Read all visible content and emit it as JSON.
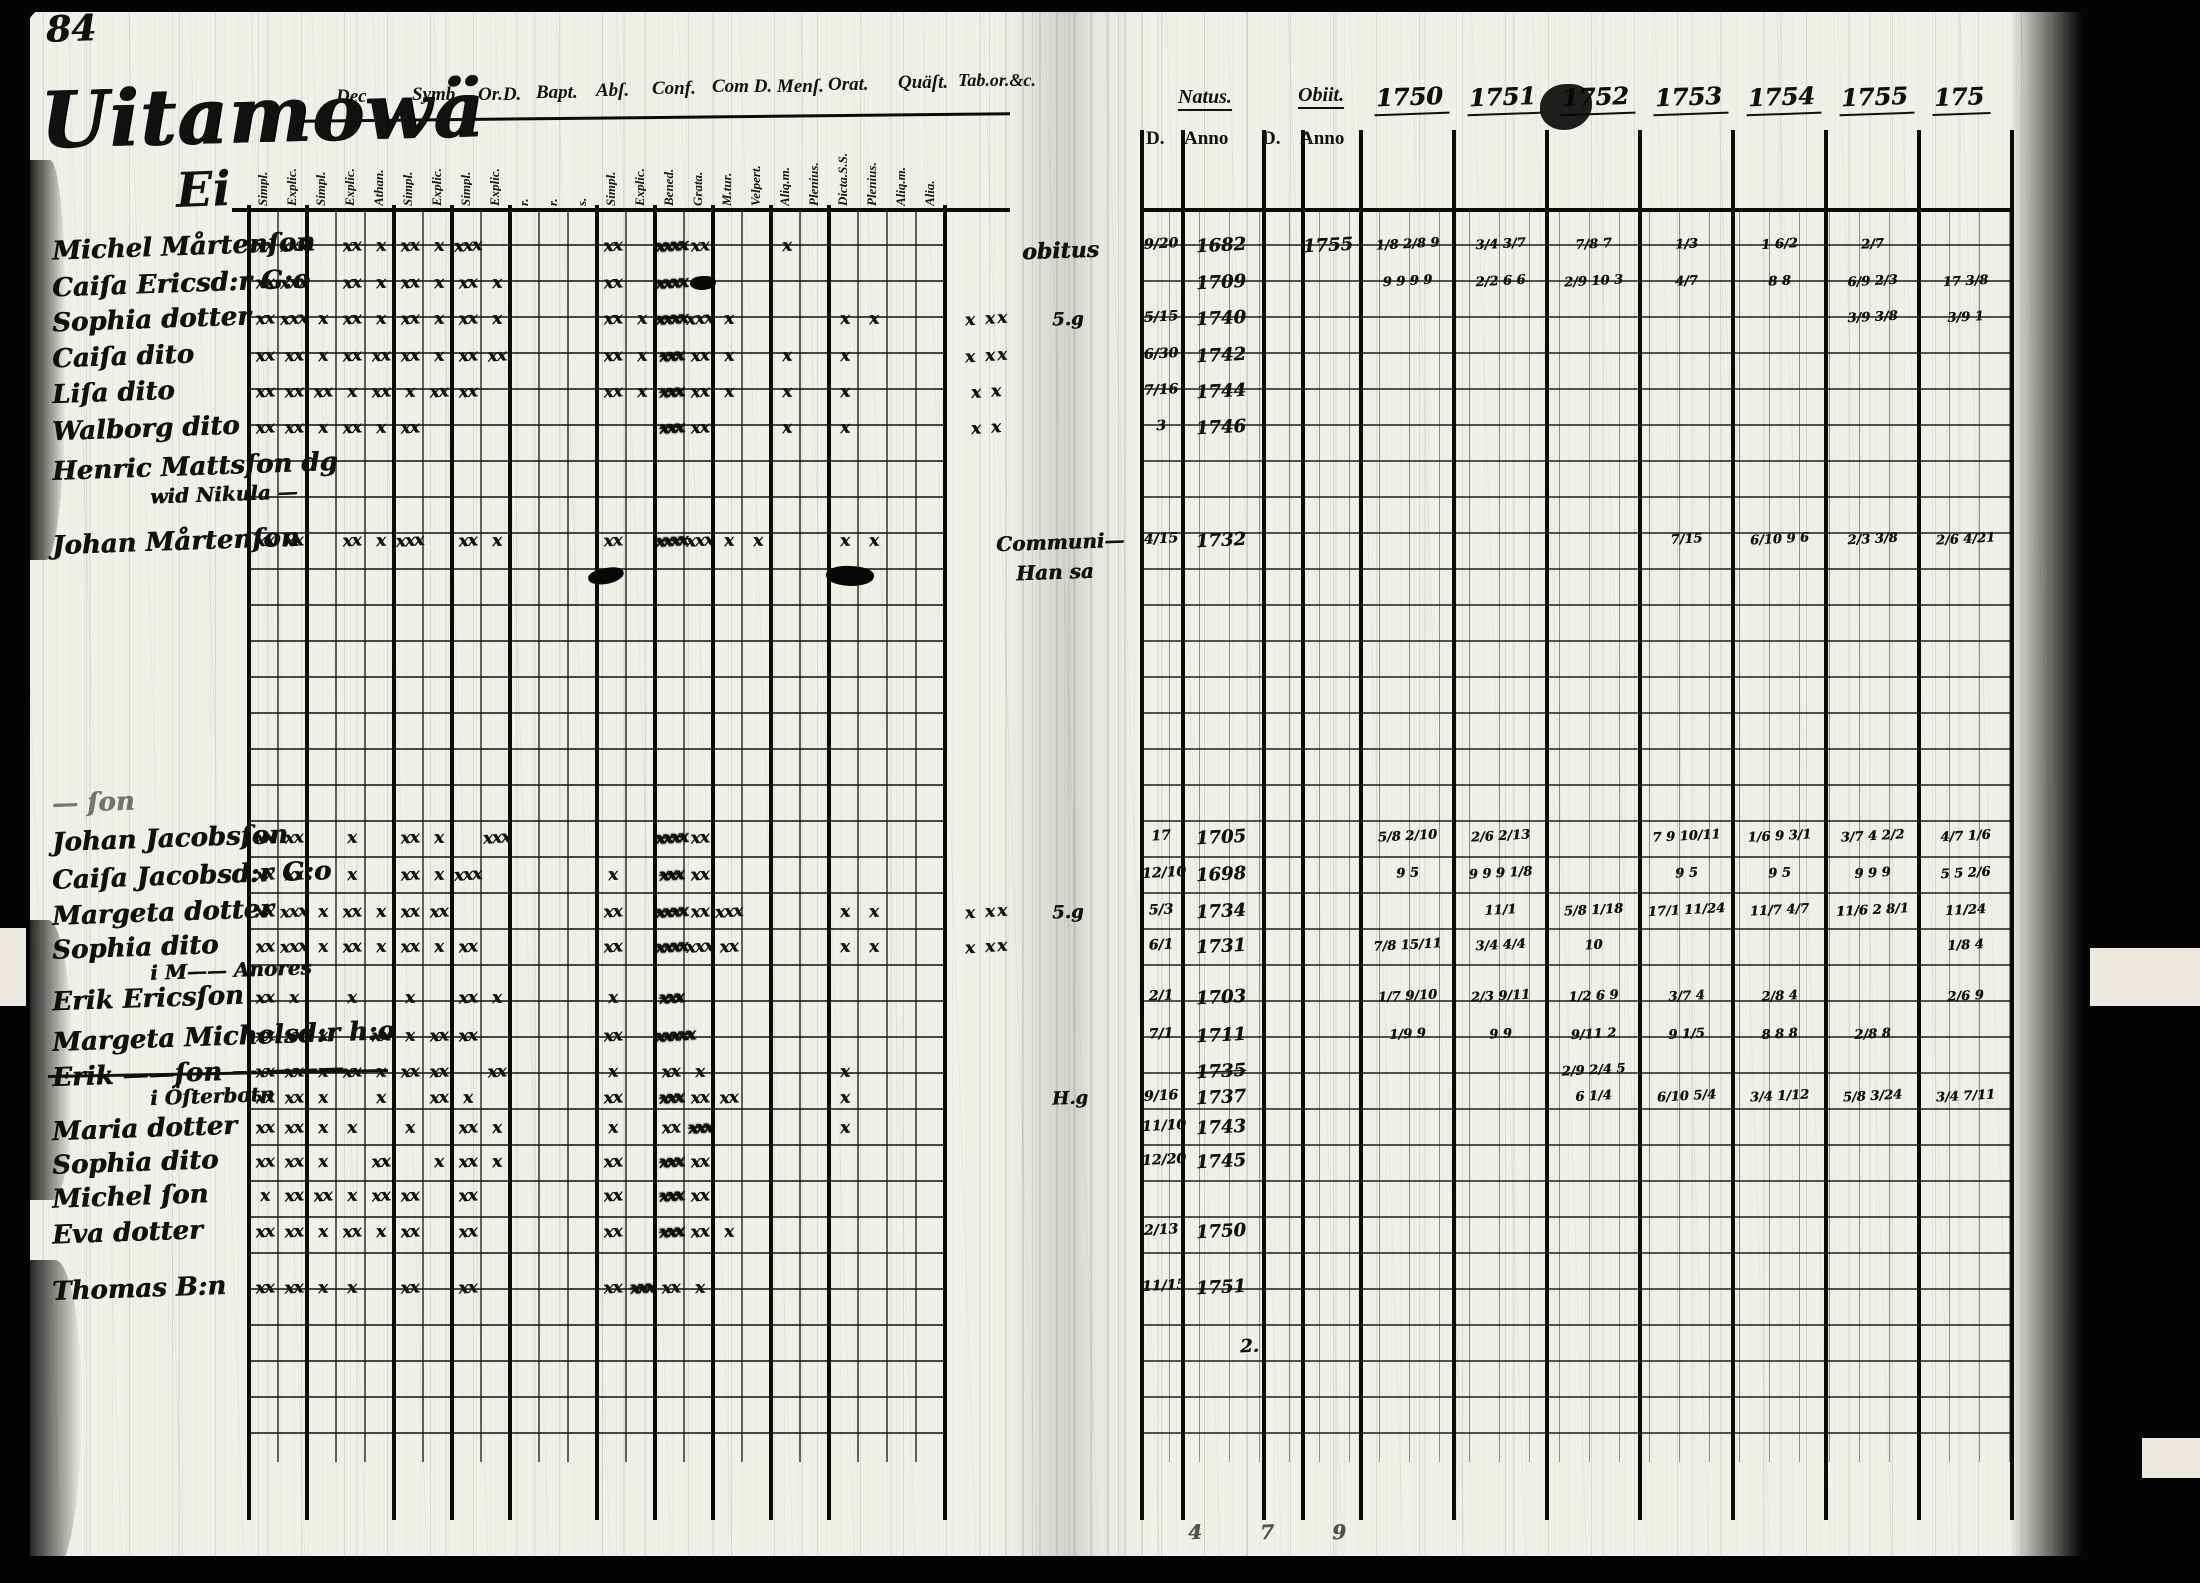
{
  "page": {
    "number": "84",
    "title_line1": "Uitamowä",
    "title_line2": "Ei"
  },
  "left_table": {
    "top_headers": [
      "Dec.",
      "Symb.",
      "Or.D.",
      "Bapt.",
      "Abſ.",
      "Conf.",
      "Com D. Menſ.",
      "Orat.",
      "Quäſt.",
      "Tab.or.&c."
    ],
    "sub_headers": [
      "Simpl.",
      "Explic.",
      "Simpl.",
      "Explic.",
      "Athan.",
      "Simpl.",
      "Explic.",
      "Simpl.",
      "Explic.",
      "r.",
      "r.",
      "s.",
      "Simpl.",
      "Explic.",
      "Bened.",
      "Grata.",
      "M.tur.",
      "Velpert.",
      "Aliq.m.",
      "Plenius.",
      "Dicta.S.S.",
      "Plenius.",
      "Aliq.m.",
      "Alia."
    ]
  },
  "right_table": {
    "natus_label": "Natus.",
    "obiit_label": "Obiit.",
    "day_anno_headers": [
      "D.",
      "Anno",
      "D.",
      "Anno"
    ],
    "year_headers": [
      "1750",
      "1751",
      "1752",
      "1753",
      "1754",
      "1755",
      "175"
    ]
  },
  "records": [
    {
      "name": "Michel Mårtenſon",
      "marks": [
        "xx",
        "xxx",
        "",
        "xx",
        "x",
        "xx",
        "x",
        "xxx",
        "",
        "",
        "",
        "",
        "xx",
        "",
        "~xxxx",
        "xx",
        "",
        "",
        "x"
      ],
      "nd": "9/20",
      "na": "1682",
      "on": "obitus",
      "oa": "1755",
      "years": [
        "1/8 2/8 9",
        "3/4 3/7",
        "7/8 7",
        "1/3",
        "1 6/2",
        "2/7",
        ""
      ]
    },
    {
      "name": "Caiſa Ericsd:r G:o",
      "marks": [
        "xx",
        "xxx",
        "",
        "xx",
        "x",
        "xx",
        "x",
        "xx",
        "x",
        "",
        "",
        "",
        "xx",
        "",
        "~xxxx",
        "x"
      ],
      "na": "1709",
      "years": [
        "9 9 9 9",
        "2/2 6 6",
        "2/9 10 3",
        "4/7",
        "8 8",
        "6/9 2/3",
        "17 3/8"
      ]
    },
    {
      "name": "Sophia dotter",
      "marks": [
        "xx",
        "xxx",
        "x",
        "xx",
        "x",
        "xx",
        "x",
        "xx",
        "x",
        "",
        "",
        "",
        "xx",
        "x",
        "~xxxx",
        "xxx",
        "x",
        "",
        "",
        "",
        "x",
        "x"
      ],
      "extra": "x xx",
      "note": "5.g",
      "nd": "5/15",
      "na": "1740",
      "years": [
        "",
        "",
        "",
        "",
        "",
        "3/9 3/8",
        "3/9 1"
      ]
    },
    {
      "name": "Caiſa dito",
      "marks": [
        "xx",
        "xx",
        "x",
        "xx",
        "xx",
        "xx",
        "x",
        "xx",
        "xx",
        "",
        "",
        "",
        "xx",
        "x",
        "~xxx",
        "xx",
        "x",
        "",
        "x",
        "",
        "x"
      ],
      "extra": "x xx",
      "nd": "6/30",
      "na": "1742"
    },
    {
      "name": "Liſa dito",
      "marks": [
        "xx",
        "xx",
        "xx",
        "x",
        "xx",
        "x",
        "xx",
        "xx",
        "",
        "",
        "",
        "",
        "xx",
        "x",
        "~xxx",
        "xx",
        "x",
        "",
        "x",
        "",
        "x"
      ],
      "extra": "x x",
      "nd": "7/16",
      "na": "1744"
    },
    {
      "name": "Walborg dito",
      "marks": [
        "xx",
        "xx",
        "x",
        "xx",
        "x",
        "xx",
        "",
        "",
        "",
        "",
        "",
        "",
        "",
        "",
        "~xxx",
        "xx",
        "",
        "",
        "x",
        "",
        "x"
      ],
      "extra": "x x",
      "nd": "3",
      "na": "1746"
    },
    {
      "name": "Henric Mattsſon dg"
    },
    {
      "name": "wid Nikula —",
      "indent": true
    },
    {
      "name": "Johan Mårtenſon",
      "marks": [
        "xx",
        "xx",
        "",
        "xx",
        "x",
        "xxx",
        "",
        "xx",
        "x",
        "",
        "",
        "",
        "xx",
        "",
        "~xxxx",
        "xxx",
        "x",
        "x",
        "",
        "",
        "x",
        "x"
      ],
      "nd": "4/15",
      "na": "1732",
      "years": [
        "",
        "",
        "",
        "7/15",
        "6/10 9 6",
        "2/3 3/8",
        "2/6 4/21"
      ]
    },
    {
      "name": "— ſon",
      "faint": true
    },
    {
      "name": "Johan Jacobsſon",
      "marks": [
        "xx",
        "xx",
        "",
        "x",
        "",
        "xx",
        "x",
        "",
        "xxx",
        "",
        "",
        "",
        "",
        "",
        "~xxxx",
        "xx"
      ],
      "nd": "17",
      "na": "1705",
      "years": [
        "5/8 2/10",
        "2/6 2/13",
        "",
        "7 9 10/11",
        "1/6 9 3/1",
        "3/7 4 2/2",
        "4/7 1/6"
      ]
    },
    {
      "name": "Caiſa Jacobsd:r G:o",
      "marks": [
        "xx",
        "xx",
        "",
        "x",
        "",
        "xx",
        "x",
        "xxx",
        "",
        "",
        "",
        "",
        "x",
        "",
        "~xxx",
        "xx"
      ],
      "nd": "12/10",
      "na": "1698",
      "years": [
        "9 5",
        "9 9 9 1/8",
        "",
        "9 5",
        "9 5",
        "9 9 9",
        "5 5 2/6"
      ]
    },
    {
      "name": "Margeta dotter",
      "marks": [
        "xx",
        "xxx",
        "x",
        "xx",
        "x",
        "xx",
        "xx",
        "",
        "",
        "",
        "",
        "",
        "xx",
        "",
        "~xxxx",
        "xx",
        "xxx",
        "",
        "",
        "",
        "x",
        "x"
      ],
      "extra": "x xx",
      "note": "5.g",
      "nd": "5/3",
      "na": "1734",
      "years": [
        "",
        "11/1",
        "5/8 1/18",
        "17/1 11/24",
        "11/7 4/7",
        "11/6 2 8/1",
        "11/24"
      ]
    },
    {
      "name": "Sophia dito",
      "marks": [
        "xx",
        "xxx",
        "x",
        "xx",
        "x",
        "xx",
        "x",
        "xx",
        "",
        "",
        "",
        "",
        "xx",
        "",
        "~xxxx",
        "xxx",
        "xx",
        "",
        "",
        "",
        "x",
        "x"
      ],
      "extra": "x xx",
      "nd": "6/1",
      "na": "1731",
      "years": [
        "7/8 15/11",
        "3/4 4/4",
        "10",
        "",
        "",
        "",
        "1/8 4"
      ]
    },
    {
      "name": "i M—— Anores",
      "indent": true
    },
    {
      "name": "Erik Ericsſon",
      "marks": [
        "xx",
        "x",
        "",
        "x",
        "",
        "x",
        "",
        "xx",
        "x",
        "",
        "",
        "",
        "x",
        "",
        "~xxx"
      ],
      "nd": "2/1",
      "na": "1703",
      "years": [
        "1/7 9/10",
        "2/3 9/11",
        "1/2 6 9",
        "3/7 4",
        "2/8 4",
        "",
        "2/6 9"
      ]
    },
    {
      "name": "Margeta Michelsd:r h:o",
      "marks": [
        "xx",
        "xx",
        "x",
        "",
        "xx",
        "x",
        "xx",
        "xx",
        "",
        "",
        "",
        "",
        "xx",
        "",
        "~xxxxx"
      ],
      "nd": "7/1",
      "na": "1711",
      "years": [
        "1/9 9",
        "9 9",
        "9/11 2",
        "9 1/5",
        "8 8 8",
        "2/8 8",
        ""
      ]
    },
    {
      "name": "Erik ——ſon — ———",
      "struck": true,
      "marks": [
        "xx",
        "xx",
        "x",
        "xx",
        "x",
        "xx",
        "xx",
        "",
        "xx",
        "",
        "",
        "",
        "x",
        "",
        "xx",
        "x",
        "",
        "",
        "",
        "",
        "x"
      ],
      "na": "1735",
      "years": [
        "",
        "",
        "2/9 2/4 5",
        "",
        "",
        "",
        ""
      ]
    },
    {
      "name": "i Öſterbotn",
      "indent": true,
      "marks": [
        "xx",
        "xx",
        "x",
        "",
        "x",
        "",
        "xx",
        "x",
        "",
        "",
        "",
        "",
        "xx",
        "",
        "~xxx",
        "xx",
        "xx",
        "",
        "",
        "",
        "x"
      ],
      "note": "H.g",
      "nd": "9/16",
      "na": "1737",
      "years": [
        "",
        "",
        "6 1/4",
        "6/10 5/4",
        "3/4 1/12",
        "5/8 3/24",
        "3/4 7/11"
      ]
    },
    {
      "name": "Maria dotter",
      "marks": [
        "xx",
        "xx",
        "x",
        "x",
        "",
        "x",
        "",
        "xx",
        "x",
        "",
        "",
        "",
        "x",
        "",
        "xx",
        "~xxx",
        "",
        "",
        "",
        "",
        "x"
      ],
      "nd": "11/10",
      "na": "1743"
    },
    {
      "name": "Sophia dito",
      "marks": [
        "xx",
        "xx",
        "x",
        "",
        "xx",
        "",
        "x",
        "xx",
        "x",
        "",
        "",
        "",
        "xx",
        "",
        "~xxx",
        "xx"
      ],
      "nd": "12/20",
      "na": "1745"
    },
    {
      "name": "Michel ſon",
      "marks": [
        "x",
        "xx",
        "xx",
        "x",
        "xx",
        "xx",
        "",
        "xx",
        "",
        "",
        "",
        "",
        "xx",
        "",
        "~xxx",
        "xx"
      ]
    },
    {
      "name": "Eva dotter",
      "marks": [
        "xx",
        "xx",
        "x",
        "xx",
        "x",
        "xx",
        "",
        "xx",
        "",
        "",
        "",
        "",
        "xx",
        "",
        "~xxx",
        "xx",
        "x"
      ],
      "nd": "2/13",
      "na": "1750"
    },
    {
      "name": "Thomas B:n",
      "marks": [
        "xx",
        "xx",
        "x",
        "x",
        "",
        "xx",
        "",
        "xx",
        "",
        "",
        "",
        "",
        "xx",
        "~xxx",
        "xx",
        "x"
      ],
      "nd": "11/15",
      "na": "1751"
    }
  ],
  "annotations": {
    "communion_note_1": "Communi—",
    "communion_note_2": "Han sa",
    "bottom_marks": [
      "4",
      "7",
      "9"
    ],
    "stray_mark": "2."
  }
}
